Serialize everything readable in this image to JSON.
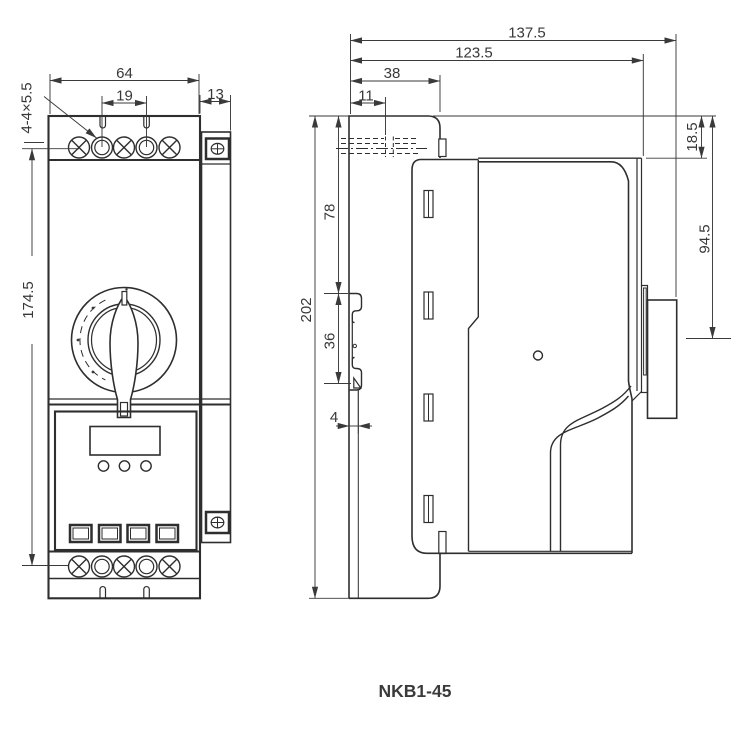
{
  "title": "NKB1-45",
  "front_view": {
    "dims": {
      "width": "64",
      "terminal_pitch": "19",
      "side_unit_width": "13",
      "mount_holes": "4-4×5.5",
      "height": "174.5"
    }
  },
  "side_view": {
    "dims": {
      "depth_total": "137.5",
      "depth_body": "123.5",
      "flange_width": "38",
      "hole_offset": "11",
      "top_inset": "18.5",
      "handle_face": "94.5",
      "height_total": "202",
      "upper_section": "78",
      "clip_section": "36",
      "plate_thickness": "4"
    }
  }
}
